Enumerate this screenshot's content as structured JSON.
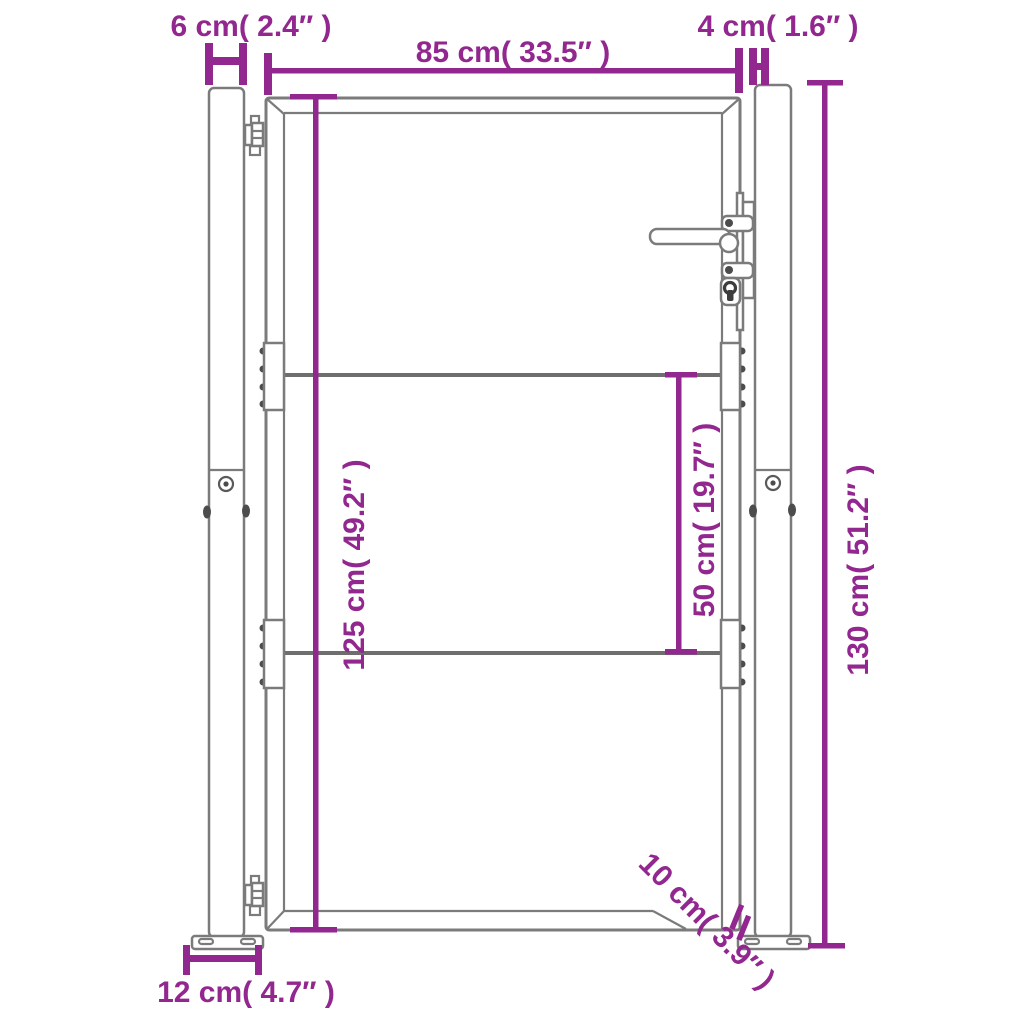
{
  "diagram": {
    "subject": "garden gate with posts - dimension drawing",
    "colors": {
      "dimension": "#92278f",
      "outline": "#7b7b7b",
      "rail": "#6e6e6e",
      "detail_dark": "#4c4c4c",
      "background": "#ffffff"
    },
    "dimensions": {
      "left_post_width": {
        "label": "6 cm( 2.4″ )"
      },
      "gate_width": {
        "label": "85 cm( 33.5″ )"
      },
      "right_post_width": {
        "label": "4 cm( 1.6″ )"
      },
      "gate_height": {
        "label": "125 cm( 49.2″ )"
      },
      "rail_gap": {
        "label": "50 cm( 19.7″ )"
      },
      "post_height": {
        "label": "130 cm( 51.2″ )"
      },
      "base_plate_width": {
        "label": "12 cm( 4.7″ )"
      },
      "base_plate_depth": {
        "label": "10 cm( 3.9″ )"
      }
    }
  }
}
